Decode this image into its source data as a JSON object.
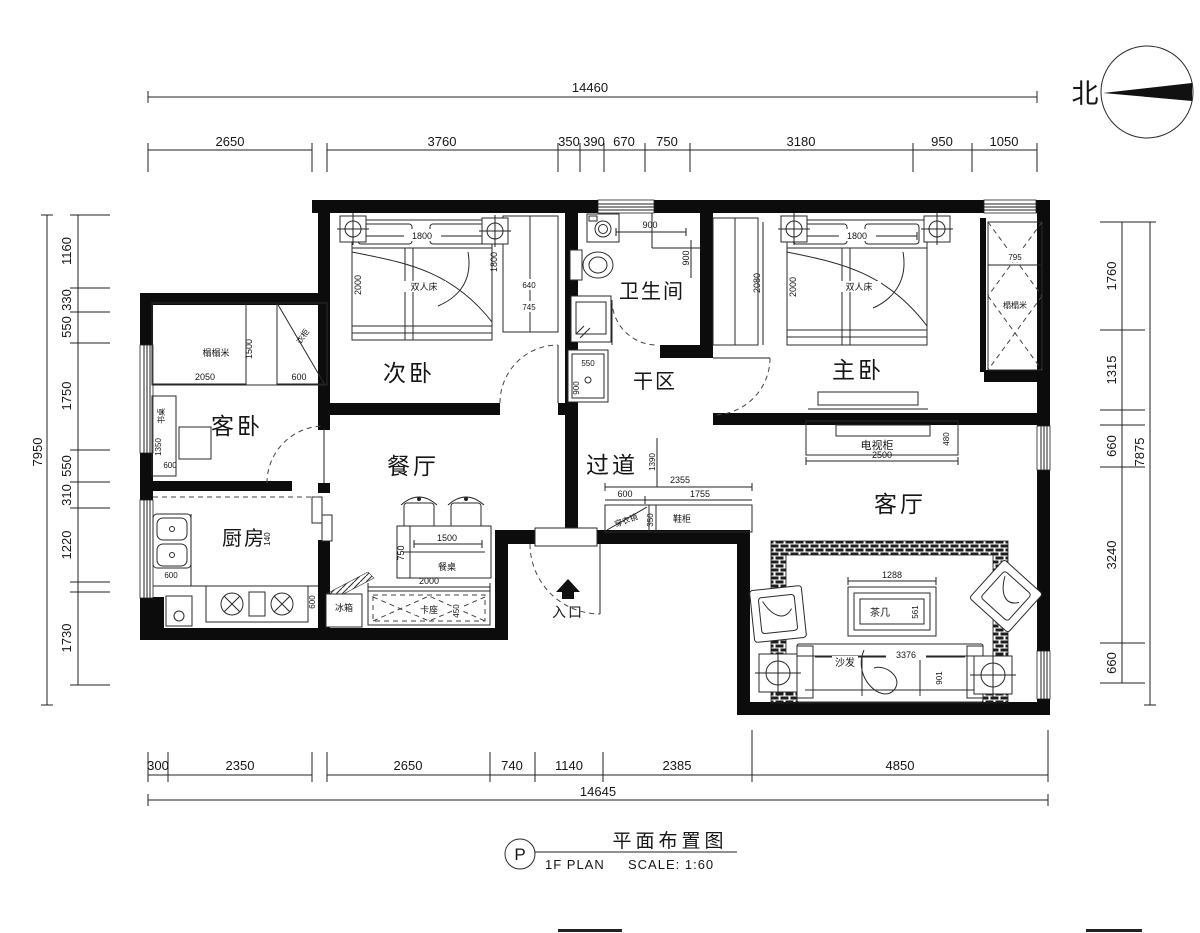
{
  "north": {
    "label": "北"
  },
  "title_block": {
    "symbol": "P",
    "title": "平面布置图",
    "plan": "1F PLAN",
    "scale": "SCALE: 1:60"
  },
  "dims": {
    "top": {
      "total": "14460",
      "segments": [
        "2650",
        "3760",
        "350",
        "390",
        "670",
        "750",
        "3180",
        "950",
        "1050"
      ]
    },
    "bottom": {
      "total": "14645",
      "segments": [
        "300",
        "2350",
        "2650",
        "740",
        "1140",
        "2385",
        "4850"
      ]
    },
    "left": {
      "total": "7950",
      "segments": [
        "1160",
        "330",
        "550",
        "1750",
        "550",
        "310",
        "1220",
        "1730"
      ]
    },
    "right": {
      "total": "7875",
      "segments": [
        "1760",
        "1315",
        "660",
        "3240",
        "660"
      ]
    }
  },
  "rooms": {
    "secondary_bedroom": "次卧",
    "bathroom": "卫生间",
    "dry_area": "干区",
    "master_bedroom": "主卧",
    "guest_bedroom": "客卧",
    "dining": "餐厅",
    "hallway": "过道",
    "kitchen": "厨房",
    "living": "客厅",
    "entrance": "入口"
  },
  "furniture": {
    "double_bed": "双人床",
    "bed_width": "1800",
    "bed_depth": "2000",
    "wardrobe_1800": "1800",
    "wardrobe_640": "640",
    "wardrobe_745": "745",
    "master_wardrobe_2080": "2080",
    "closet_795": "795",
    "closet_tatami": "榻榻米",
    "tatami": "榻榻米",
    "tatami_1500": "1500",
    "tatami_2050": "2050",
    "tatami_600": "600",
    "closet_label": "衣柜",
    "desk": "书桌",
    "desk_1350": "1350",
    "desk_600": "600",
    "sink_600": "600",
    "kitchen_140": "140",
    "kitchen_600": "600",
    "fridge": "冰箱",
    "dining_table": "餐桌",
    "table_1500": "1500",
    "table_750": "750",
    "dining_2000": "2000",
    "bench": "卡座",
    "bench_450": "450",
    "shower_900w": "900",
    "shower_900d": "900",
    "basin_550": "550",
    "basin_900": "900",
    "hall_1390": "1390",
    "hall_2355": "2355",
    "hall_600": "600",
    "hall_1755": "1755",
    "hall_350": "350",
    "mirror": "穿衣镜",
    "shoe_cabinet": "鞋柜",
    "tv_cabinet": "电视柜",
    "tv_2500": "2500",
    "tv_480": "480",
    "tea_table": "茶几",
    "tea_1288": "1288",
    "tea_561": "561",
    "sofa": "沙发",
    "sofa_3376": "3376",
    "sofa_901": "901"
  }
}
